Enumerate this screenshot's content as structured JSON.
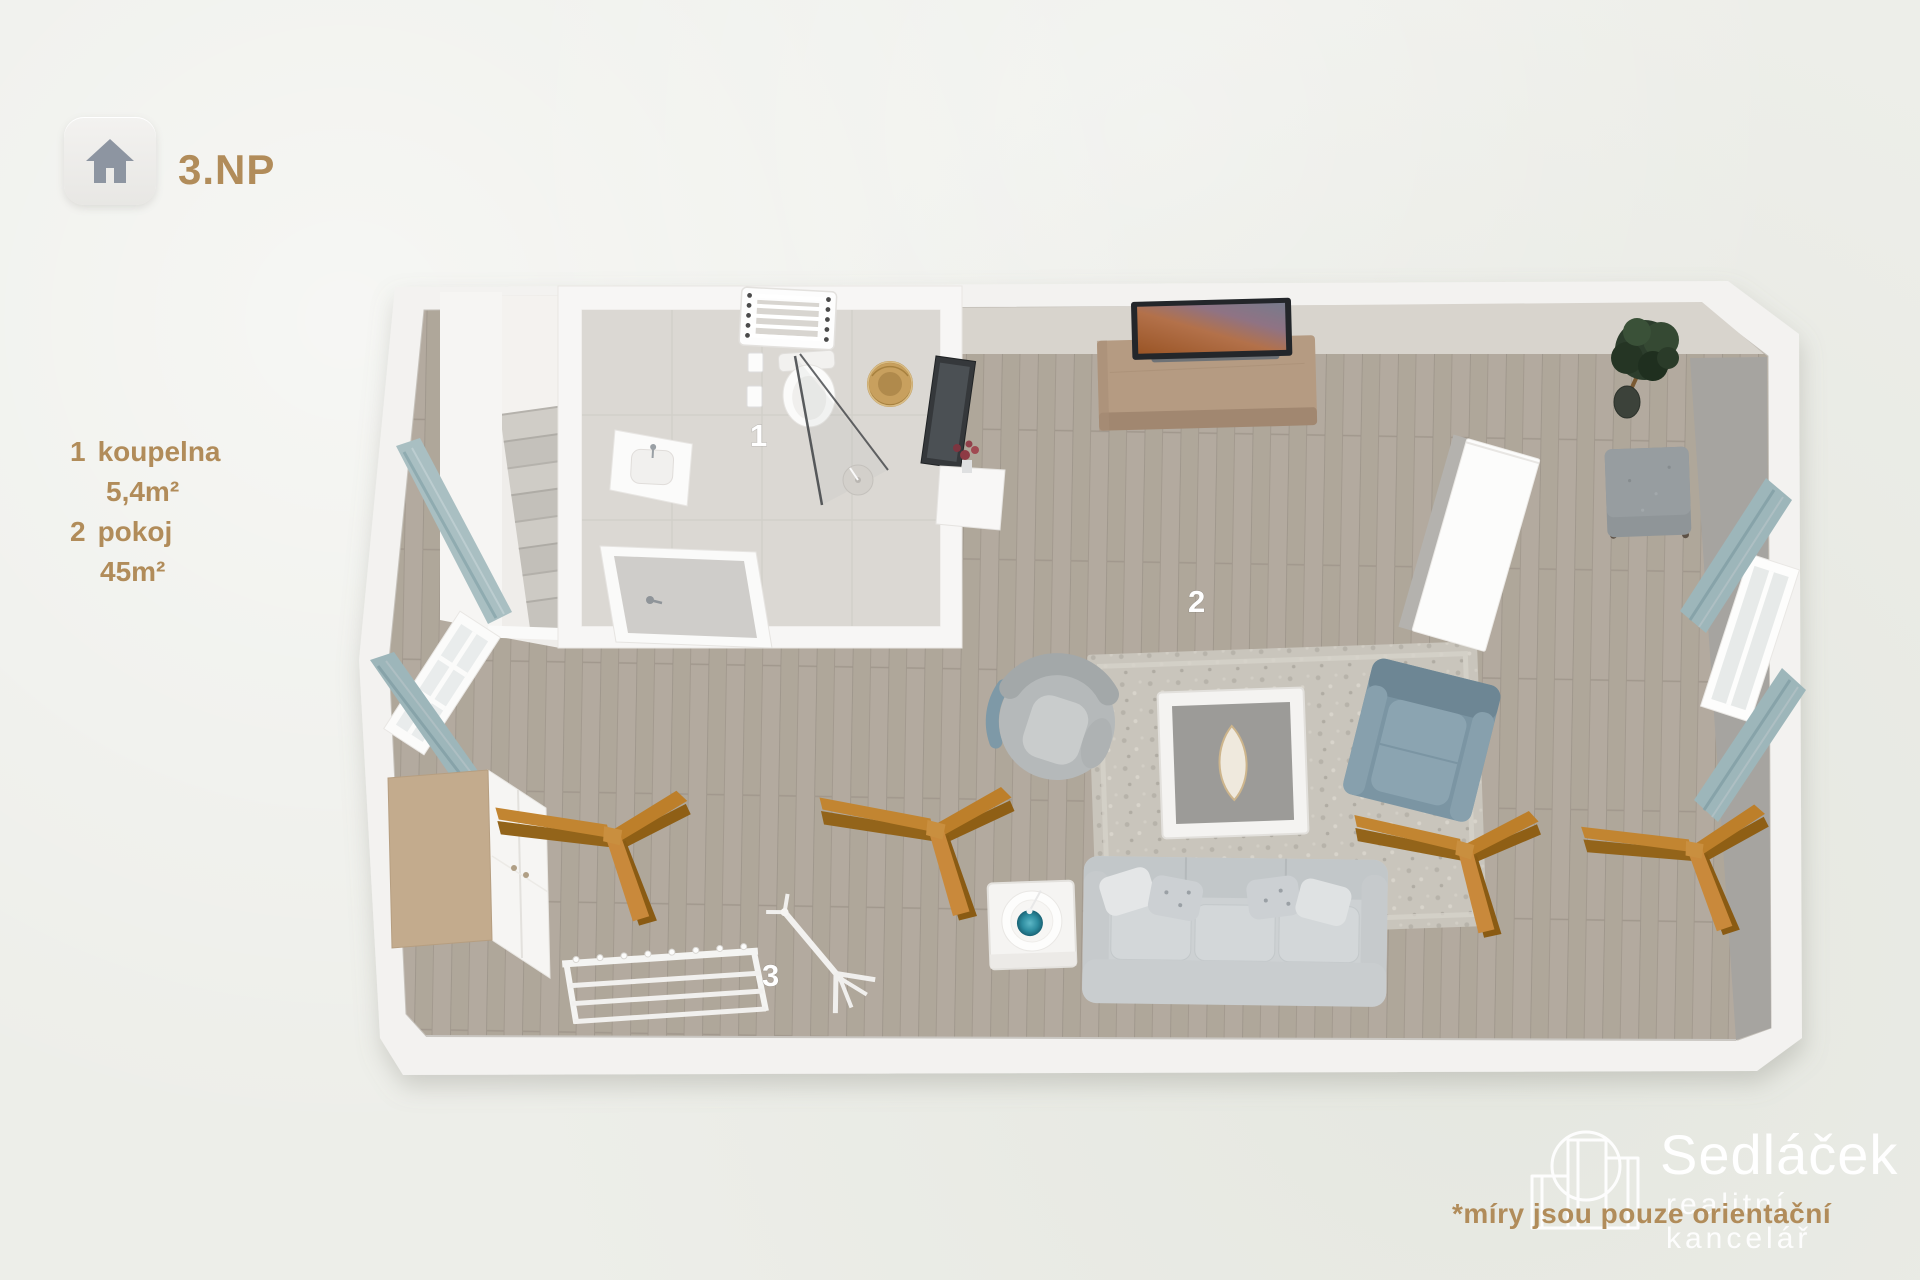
{
  "floor_selector": {
    "label": "3.NP",
    "icon": "home-icon"
  },
  "legend": {
    "items": [
      {
        "number": "1",
        "name": "koupelna",
        "area": "5,4m²"
      },
      {
        "number": "2",
        "name": "pokoj",
        "area": "45m²"
      }
    ]
  },
  "plan_labels": {
    "bathroom": "1",
    "room": "2",
    "coat_rack": "3"
  },
  "branding": {
    "name": "Sedláček",
    "tagline": "realitní kancelář",
    "logo_icon": "buildings-logo-icon"
  },
  "disclaimer": "*míry jsou pouze orientační",
  "colors": {
    "accent_tan": "#b18c5a",
    "label_white": "#ffffff",
    "curtain_teal": "#9db6ba",
    "beam_wood": "#c28531",
    "floor_wood": "#b3aa9f",
    "armchair_blue": "#7b95a3",
    "sofa_gray": "#cdd1d3",
    "wall_white": "#f3f2f0",
    "wall_gray_face": "#a6a4a0"
  }
}
